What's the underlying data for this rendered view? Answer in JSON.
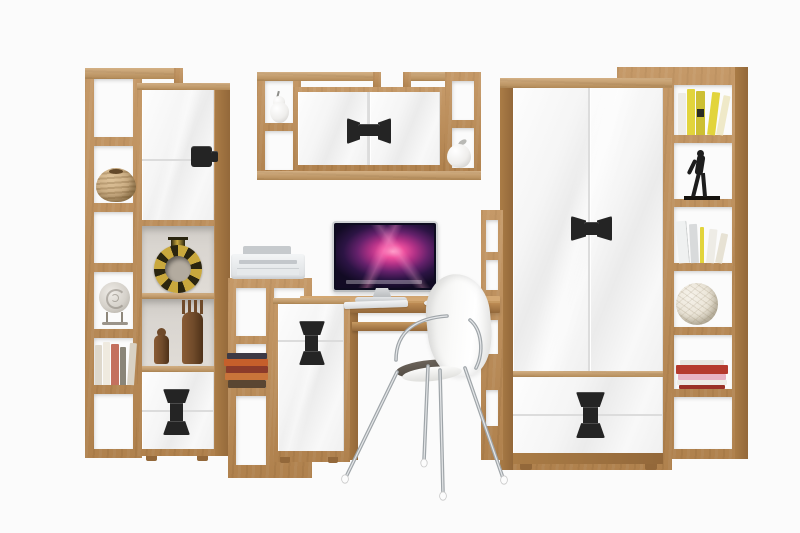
{
  "image": {
    "type": "product-photo",
    "subject": "Home office wall-unit furniture set: oak carcass with white gloss fronts and black accent handles, staged with decor, iMac-style computer, printer and white shell chair",
    "visible_text": "none"
  },
  "palette": {
    "bg": "#fbfbfb",
    "oak": "#bd8b53",
    "oak_light": "#d4a873",
    "oak_face": "#c79a62",
    "oak_side": "#aa7c46",
    "oak_dark": "#93683a",
    "white_front": "#f6f6f6",
    "front_line": "#dcdcdc",
    "handle": "#242424",
    "cell_back": "#d9d5d0",
    "chrome": "#a9afb3",
    "chrome_hi": "#e4e6e8",
    "silver": "#d3d6d8",
    "screen_pink": "#ee4f9e",
    "screen_deep": "#120b24",
    "printer_body": "#eceef0",
    "printer_dark": "#c6cacd",
    "chair_white": "#f7f7f6",
    "seat_dark": "#4c463e",
    "basket": "#c9ab81",
    "mask_gold": "#c9a83d",
    "mask_dark": "#2a250f",
    "wood_fig": "#6f4a2a",
    "ceramic": "#efeeec",
    "yellow_book": "#e2d43c",
    "yellow_book2": "#cdbf33",
    "statue_black": "#1d1d1d",
    "rattan": "#ebe5d8",
    "red_book": "#b53a2e",
    "pink_book": "#e8b3c4",
    "white_book": "#eeece6",
    "book_navy": "#3d3a45",
    "book_orange": "#c65f2b",
    "book_rust": "#8c3b2a",
    "book_brown": "#5a4632",
    "gray_book": "#d8dadb"
  },
  "furniture": [
    {
      "id": "left-bookcase",
      "label": "tall open-shelf bookcase",
      "finish": "oak"
    },
    {
      "id": "left-tall-cabinet",
      "label": "tall cabinet with gloss door, open display niche and two drawers",
      "front": "white gloss",
      "handles": "black"
    },
    {
      "id": "wall-shelf",
      "label": "wall-mounted shelf with two gloss doors and open side niches"
    },
    {
      "id": "printer-stand",
      "label": "stepped open shelf stand"
    },
    {
      "id": "desk-cabinet",
      "label": "under-desk cabinet with gloss front"
    },
    {
      "id": "desk",
      "label": "computer desk with keyboard tray",
      "finish": "oak"
    },
    {
      "id": "side-column",
      "label": "narrow open shelf column beside wardrobe"
    },
    {
      "id": "wardrobe",
      "label": "two-door wardrobe with two drawers",
      "front": "white gloss",
      "handles": "black"
    },
    {
      "id": "right-bookcase",
      "label": "tall open-shelf bookcase",
      "finish": "oak"
    },
    {
      "id": "chair",
      "label": "white shell chair with chrome legs"
    }
  ],
  "decor": [
    {
      "id": "woven-basket",
      "shelf": "left-bookcase"
    },
    {
      "id": "spiral-shell",
      "shelf": "left-bookcase"
    },
    {
      "id": "book-row",
      "shelf": "left-bookcase"
    },
    {
      "id": "gold-ring-vessel",
      "shelf": "left-tall-cabinet niche"
    },
    {
      "id": "tribal-figurines",
      "count": 2,
      "shelf": "left-tall-cabinet niche"
    },
    {
      "id": "ceramic-pear",
      "shelf": "wall-shelf"
    },
    {
      "id": "ceramic-apple",
      "shelf": "wall-shelf"
    },
    {
      "id": "book-stack",
      "shelf": "printer-stand"
    },
    {
      "id": "yellow-books",
      "shelf": "right-bookcase"
    },
    {
      "id": "black-statuette",
      "shelf": "right-bookcase"
    },
    {
      "id": "leaning-binders",
      "shelf": "right-bookcase"
    },
    {
      "id": "rattan-ball",
      "shelf": "right-bookcase"
    },
    {
      "id": "red-pink-books",
      "shelf": "right-bookcase"
    }
  ],
  "electronics": [
    {
      "id": "imac",
      "detail": "all-in-one computer, dark screen with pink-magenta galaxy wallpaper and dock strip, aluminum stand, keyboard and mouse"
    },
    {
      "id": "printer",
      "detail": "compact white inkjet printer"
    }
  ]
}
